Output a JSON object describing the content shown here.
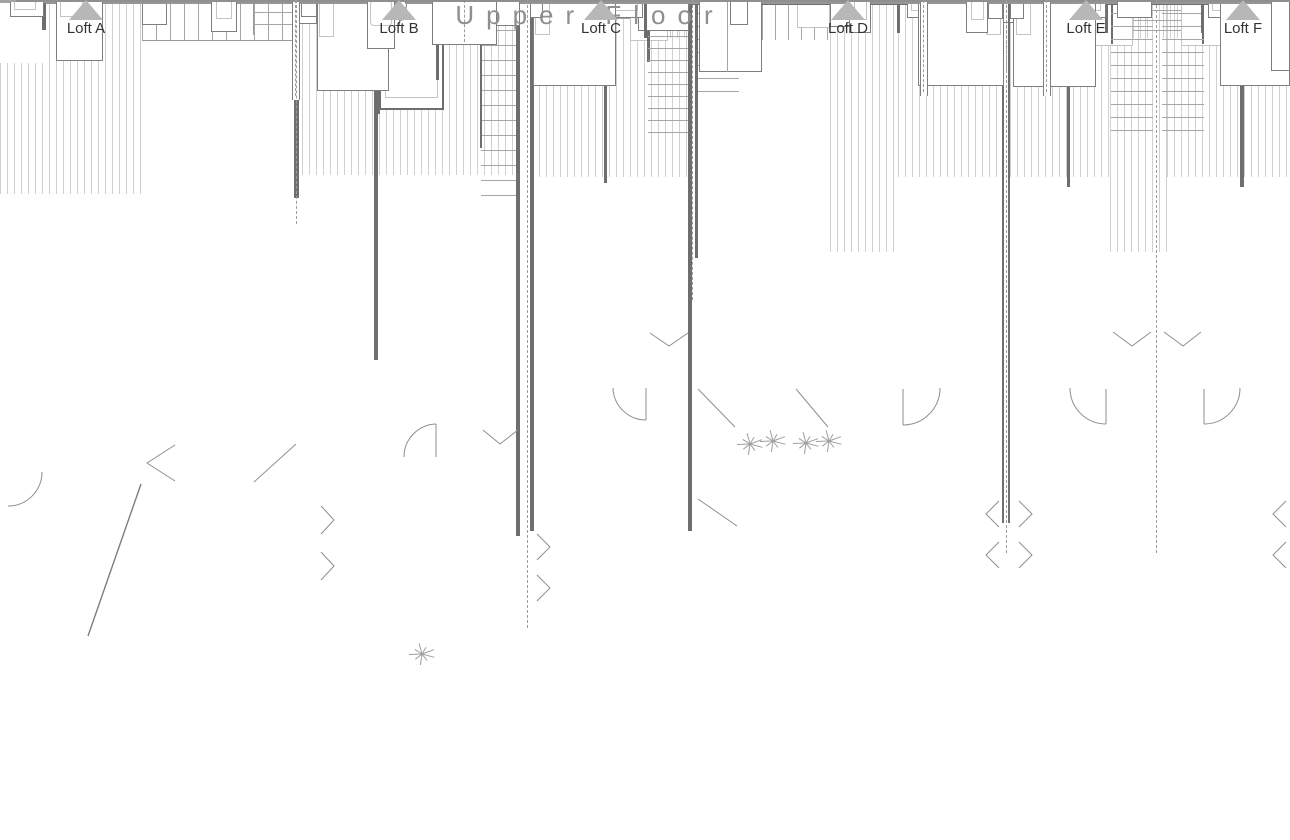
{
  "title": "Upper Floor",
  "units": [
    {
      "id": "loft-a",
      "label": "Loft A"
    },
    {
      "id": "loft-b",
      "label": "Loft B"
    },
    {
      "id": "loft-c",
      "label": "Loft C"
    },
    {
      "id": "loft-d",
      "label": "Loft D"
    },
    {
      "id": "loft-e",
      "label": "Loft E"
    },
    {
      "id": "loft-f",
      "label": "Loft F"
    }
  ],
  "plants": [
    {
      "x": 422,
      "y": 654
    },
    {
      "x": 750,
      "y": 444
    },
    {
      "x": 773,
      "y": 441
    },
    {
      "x": 806,
      "y": 443
    },
    {
      "x": 829,
      "y": 441
    }
  ],
  "colors": {
    "wall": "#6e6e6e",
    "light_line": "#a3a3a3",
    "hatch": "#d0d0d0",
    "plant": "#9e9e9e",
    "marker": "#b7b7b7",
    "title_text": "#8f8f8f",
    "label_text": "#333333",
    "ground": "#8f8f8f"
  }
}
